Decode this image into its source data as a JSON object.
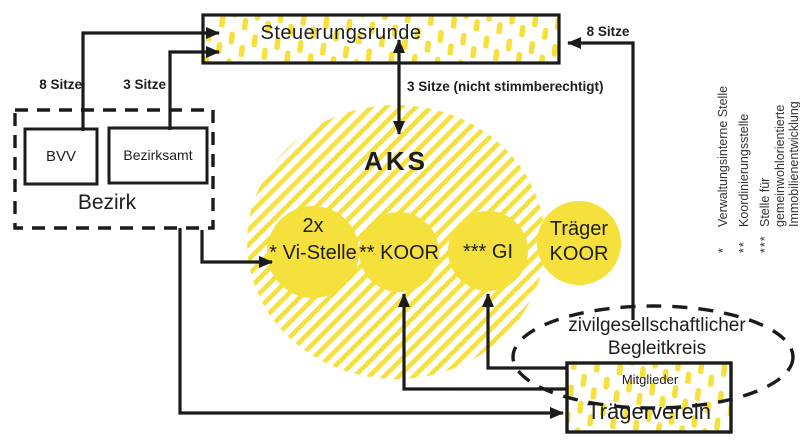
{
  "colors": {
    "yellow": "#F5E03C",
    "ink": "#1B1B1B"
  },
  "steuerungsrunde": {
    "label": "Steuerungsrunde"
  },
  "bezirk": {
    "label": "Bezirk",
    "bvv": "BVV",
    "bezirksamt": "Bezirksamt"
  },
  "edges": {
    "bvv_sitze": "8 Sitze",
    "bezirksamt_sitze": "3 Sitze",
    "aks_sitze": "3 Sitze (nicht stimmberechtigt)",
    "begleitkreis_sitze": "8 Sitze"
  },
  "aks": {
    "title": "AKS",
    "circles": [
      {
        "line1": "2x",
        "line2": "* Vi-Stelle"
      },
      {
        "line1": "** KOOR"
      },
      {
        "line1": "*** GI"
      },
      {
        "line1": "Träger",
        "line2": "KOOR"
      }
    ]
  },
  "begleitkreis": {
    "line1": "zivilgesellschaftlicher",
    "line2": "Begleitkreis"
  },
  "traegerverein": {
    "members": "Mitglieder",
    "label": "Trägerverein"
  },
  "legend": [
    {
      "marker": "*",
      "text": "Verwaltungsinterne Stelle"
    },
    {
      "marker": "**",
      "text": "Koordinierungsstelle"
    },
    {
      "marker": "***",
      "text": "Stelle für gemeinwohlorientierte",
      "text2": "Immobilienentwicklung"
    }
  ]
}
